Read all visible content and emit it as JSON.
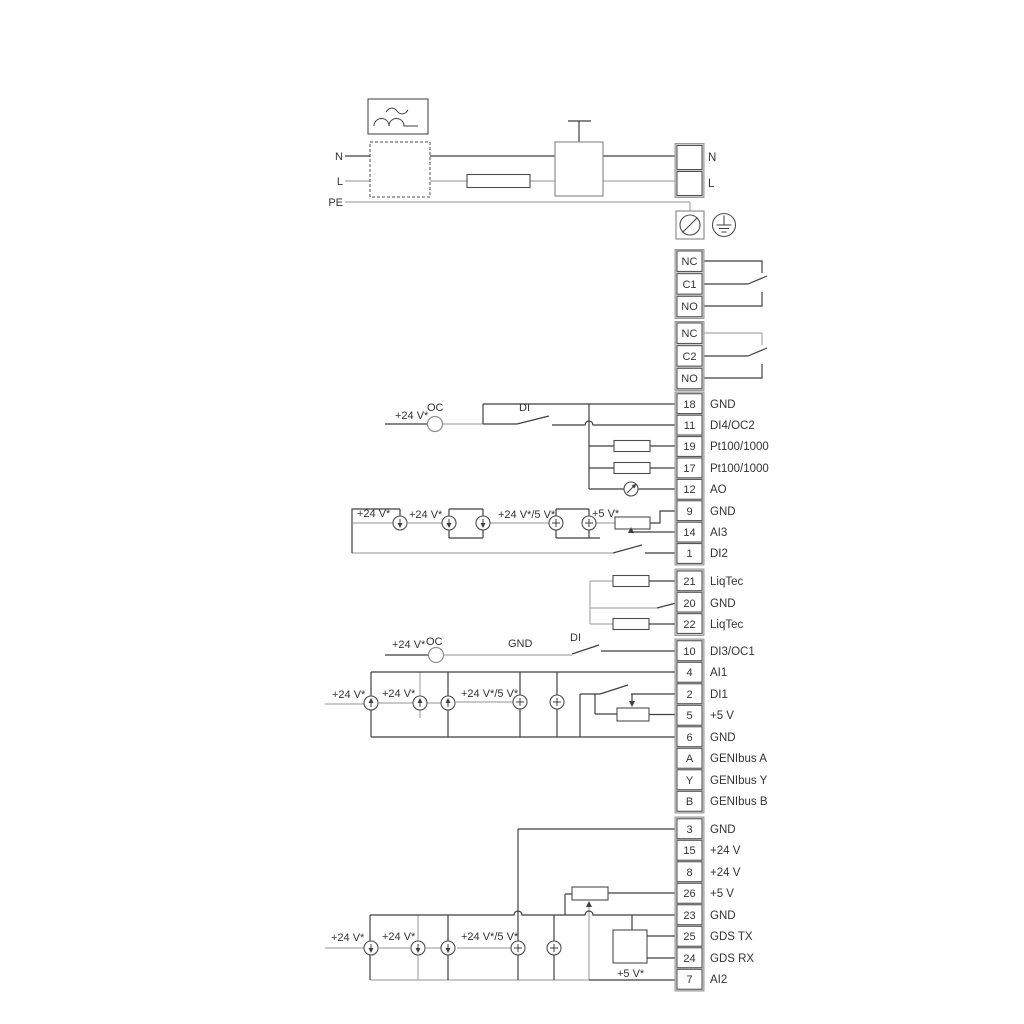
{
  "colors": {
    "wire_dark": "#3f3f3f",
    "wire_gray": "#a9a9a9",
    "background": "#ffffff"
  },
  "power": {
    "n_in": "N",
    "l_in": "L",
    "pe": "PE",
    "n_out": "N",
    "l_out": "L"
  },
  "relay1": {
    "nc": "NC",
    "c": "C1",
    "no": "NO"
  },
  "relay2": {
    "nc": "NC",
    "c": "C2",
    "no": "NO"
  },
  "io1": [
    {
      "id": "18",
      "label": "GND"
    },
    {
      "id": "11",
      "label": "DI4/OC2"
    },
    {
      "id": "19",
      "label": "Pt100/1000"
    },
    {
      "id": "17",
      "label": "Pt100/1000"
    },
    {
      "id": "12",
      "label": "AO"
    },
    {
      "id": "9",
      "label": "GND"
    },
    {
      "id": "14",
      "label": "AI3"
    },
    {
      "id": "1",
      "label": "DI2"
    }
  ],
  "io2": [
    {
      "id": "21",
      "label": "LiqTec"
    },
    {
      "id": "20",
      "label": "GND"
    },
    {
      "id": "22",
      "label": "LiqTec"
    }
  ],
  "io3": [
    {
      "id": "10",
      "label": "DI3/OC1"
    },
    {
      "id": "4",
      "label": "AI1"
    },
    {
      "id": "2",
      "label": "DI1"
    },
    {
      "id": "5",
      "label": "+5 V"
    },
    {
      "id": "6",
      "label": "GND"
    },
    {
      "id": "A",
      "label": "GENIbus A"
    },
    {
      "id": "Y",
      "label": "GENIbus Y"
    },
    {
      "id": "B",
      "label": "GENIbus B"
    }
  ],
  "io4": [
    {
      "id": "3",
      "label": "GND"
    },
    {
      "id": "15",
      "label": "+24 V"
    },
    {
      "id": "8",
      "label": "+24 V"
    },
    {
      "id": "26",
      "label": "+5 V"
    },
    {
      "id": "23",
      "label": "GND"
    },
    {
      "id": "25",
      "label": "GDS TX"
    },
    {
      "id": "24",
      "label": "GDS RX"
    },
    {
      "id": "7",
      "label": "AI2"
    }
  ],
  "sym": {
    "v24": "+24 V*",
    "v24v5": "+24 V*/5 V*",
    "v5": "+5 V*",
    "oc": "OC",
    "di": "DI",
    "gnd": "GND"
  }
}
